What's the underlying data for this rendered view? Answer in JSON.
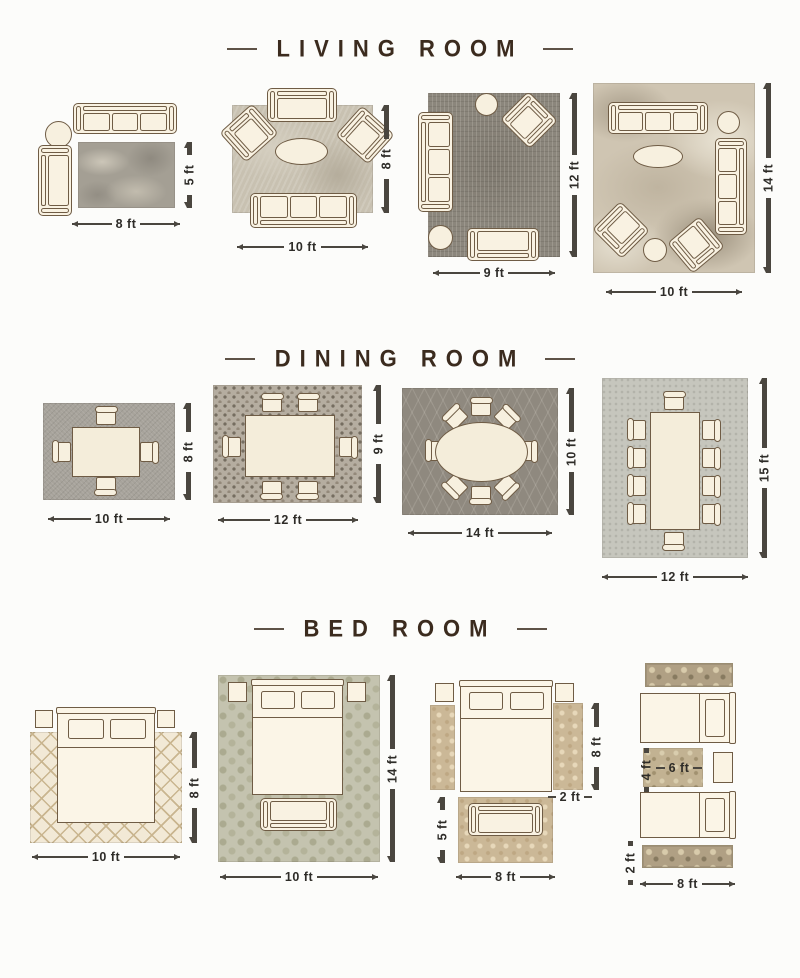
{
  "palette": {
    "background": "#fcfcfa",
    "title_color": "#3b2b1e",
    "dimension_color": "#2e2c28",
    "furniture_fill": "#f9f2e2",
    "furniture_outline": "#6f5c45"
  },
  "sections": [
    {
      "title": "LIVING ROOM",
      "layouts": [
        {
          "w": "8 ft",
          "h": "5 ft"
        },
        {
          "w": "10 ft",
          "h": "8 ft"
        },
        {
          "w": "9 ft",
          "h": "12 ft"
        },
        {
          "w": "10 ft",
          "h": "14 ft"
        }
      ]
    },
    {
      "title": "DINING ROOM",
      "layouts": [
        {
          "w": "10 ft",
          "h": "8 ft"
        },
        {
          "w": "12 ft",
          "h": "9 ft"
        },
        {
          "w": "14 ft",
          "h": "10 ft"
        },
        {
          "w": "12 ft",
          "h": "15 ft"
        }
      ]
    },
    {
      "title": "BED ROOM",
      "layouts": [
        {
          "w": "10 ft",
          "h": "8 ft"
        },
        {
          "w": "10 ft",
          "h": "14 ft"
        },
        {
          "w": "8 ft",
          "h": "5 ft",
          "runner_h": "8 ft",
          "runner_w": "2 ft"
        },
        {
          "w": "8 ft",
          "runner_w": "2 ft",
          "mid_w": "6 ft",
          "mid_h": "4 ft"
        }
      ]
    }
  ]
}
